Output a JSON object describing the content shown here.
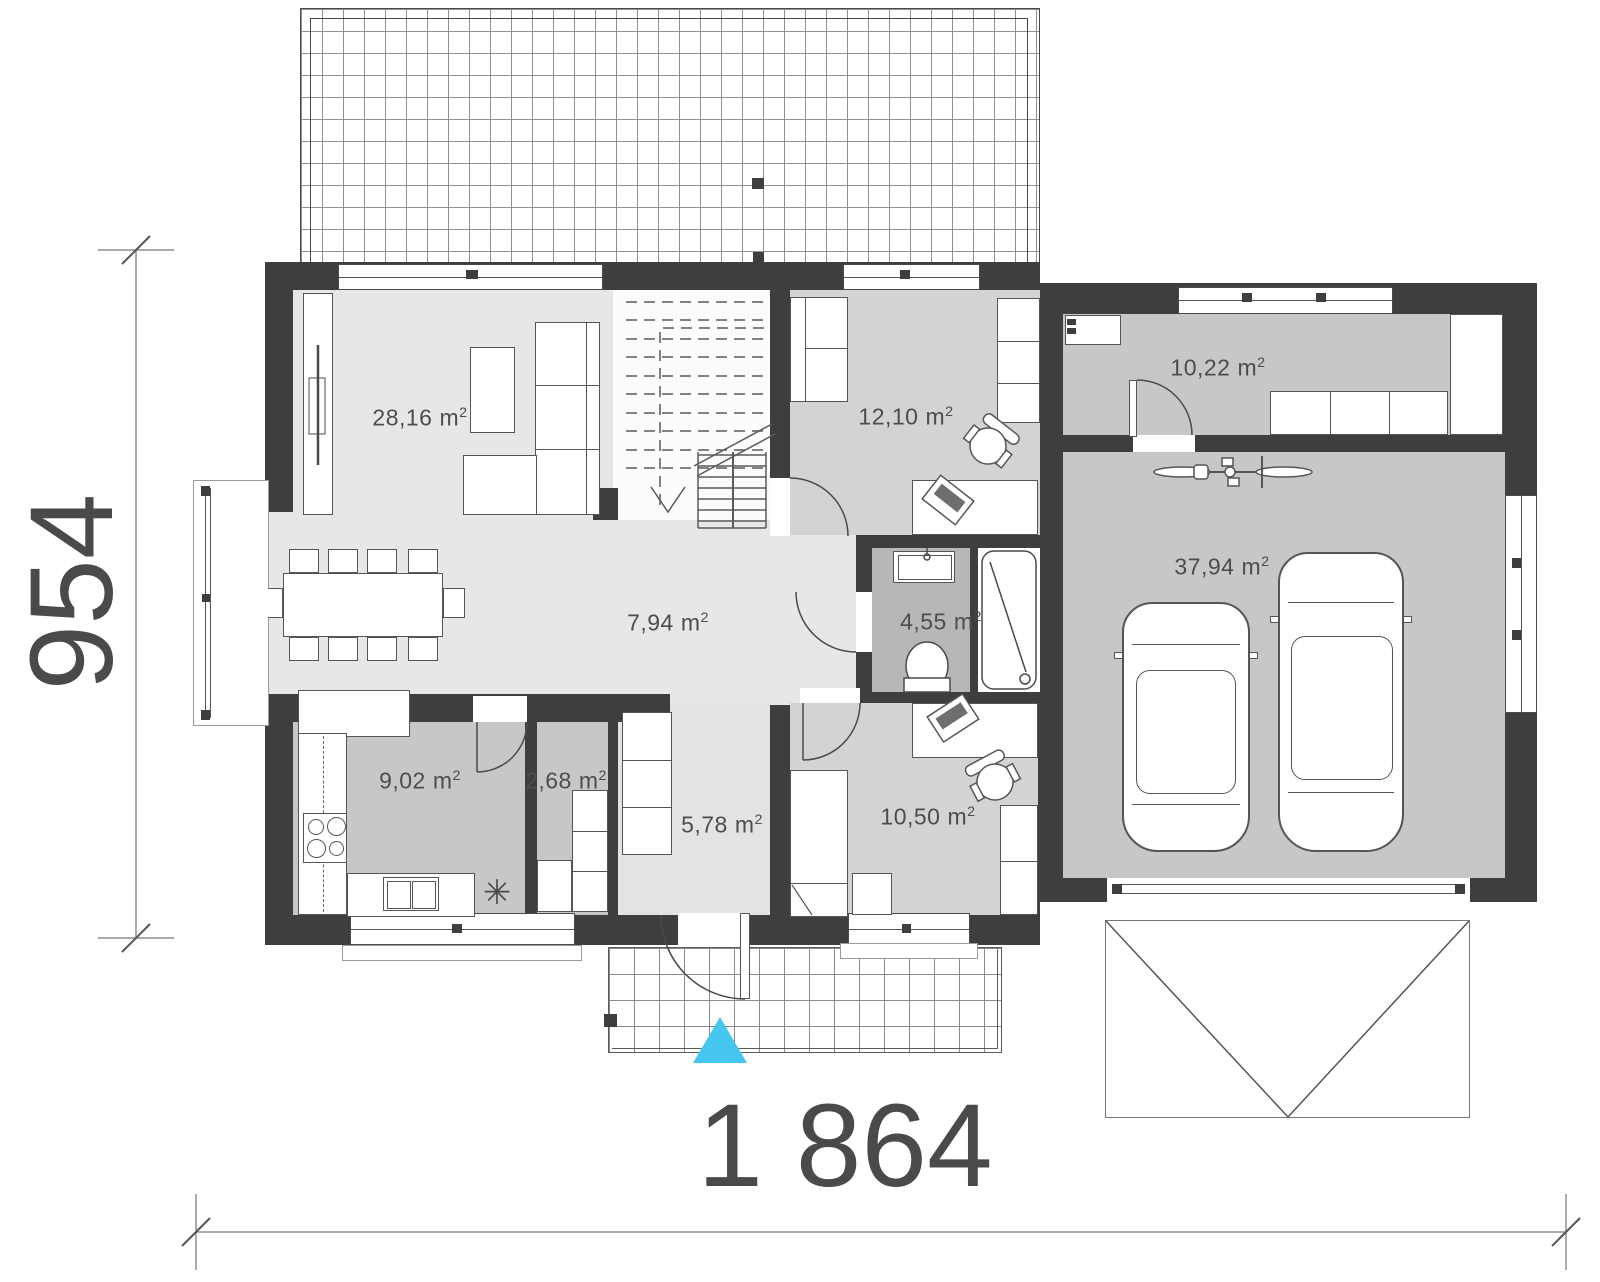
{
  "plan": {
    "type": "house ground floor plan",
    "overall_width_label": "1 864",
    "overall_depth_label": "954"
  },
  "units": {
    "base": "m",
    "sup": "2"
  },
  "rooms": [
    {
      "name": "living-room",
      "area": "28,16"
    },
    {
      "name": "office-bedroom",
      "area": "12,10"
    },
    {
      "name": "utility-room",
      "area": "10,22"
    },
    {
      "name": "garage",
      "area": "37,94"
    },
    {
      "name": "hallway",
      "area": "7,94"
    },
    {
      "name": "bathroom",
      "area": "4,55"
    },
    {
      "name": "kitchen",
      "area": "9,02"
    },
    {
      "name": "pantry",
      "area": "2,68"
    },
    {
      "name": "entrance-hall",
      "area": "5,78"
    },
    {
      "name": "bedroom",
      "area": "10,50"
    }
  ],
  "symbols": {
    "boiler_mark": "✳",
    "entrance_marker_color": "#45c7f2"
  },
  "colors": {
    "walls": "#3e3e3e",
    "floor_light": "#e7e7e7",
    "floor_mid": "#d3d3d3",
    "floor_service": "#c7c7c7",
    "floor_bath": "#b7b7b7",
    "stair_floor": "#fcfcfc",
    "dimension_text": "#4a4a4a"
  }
}
